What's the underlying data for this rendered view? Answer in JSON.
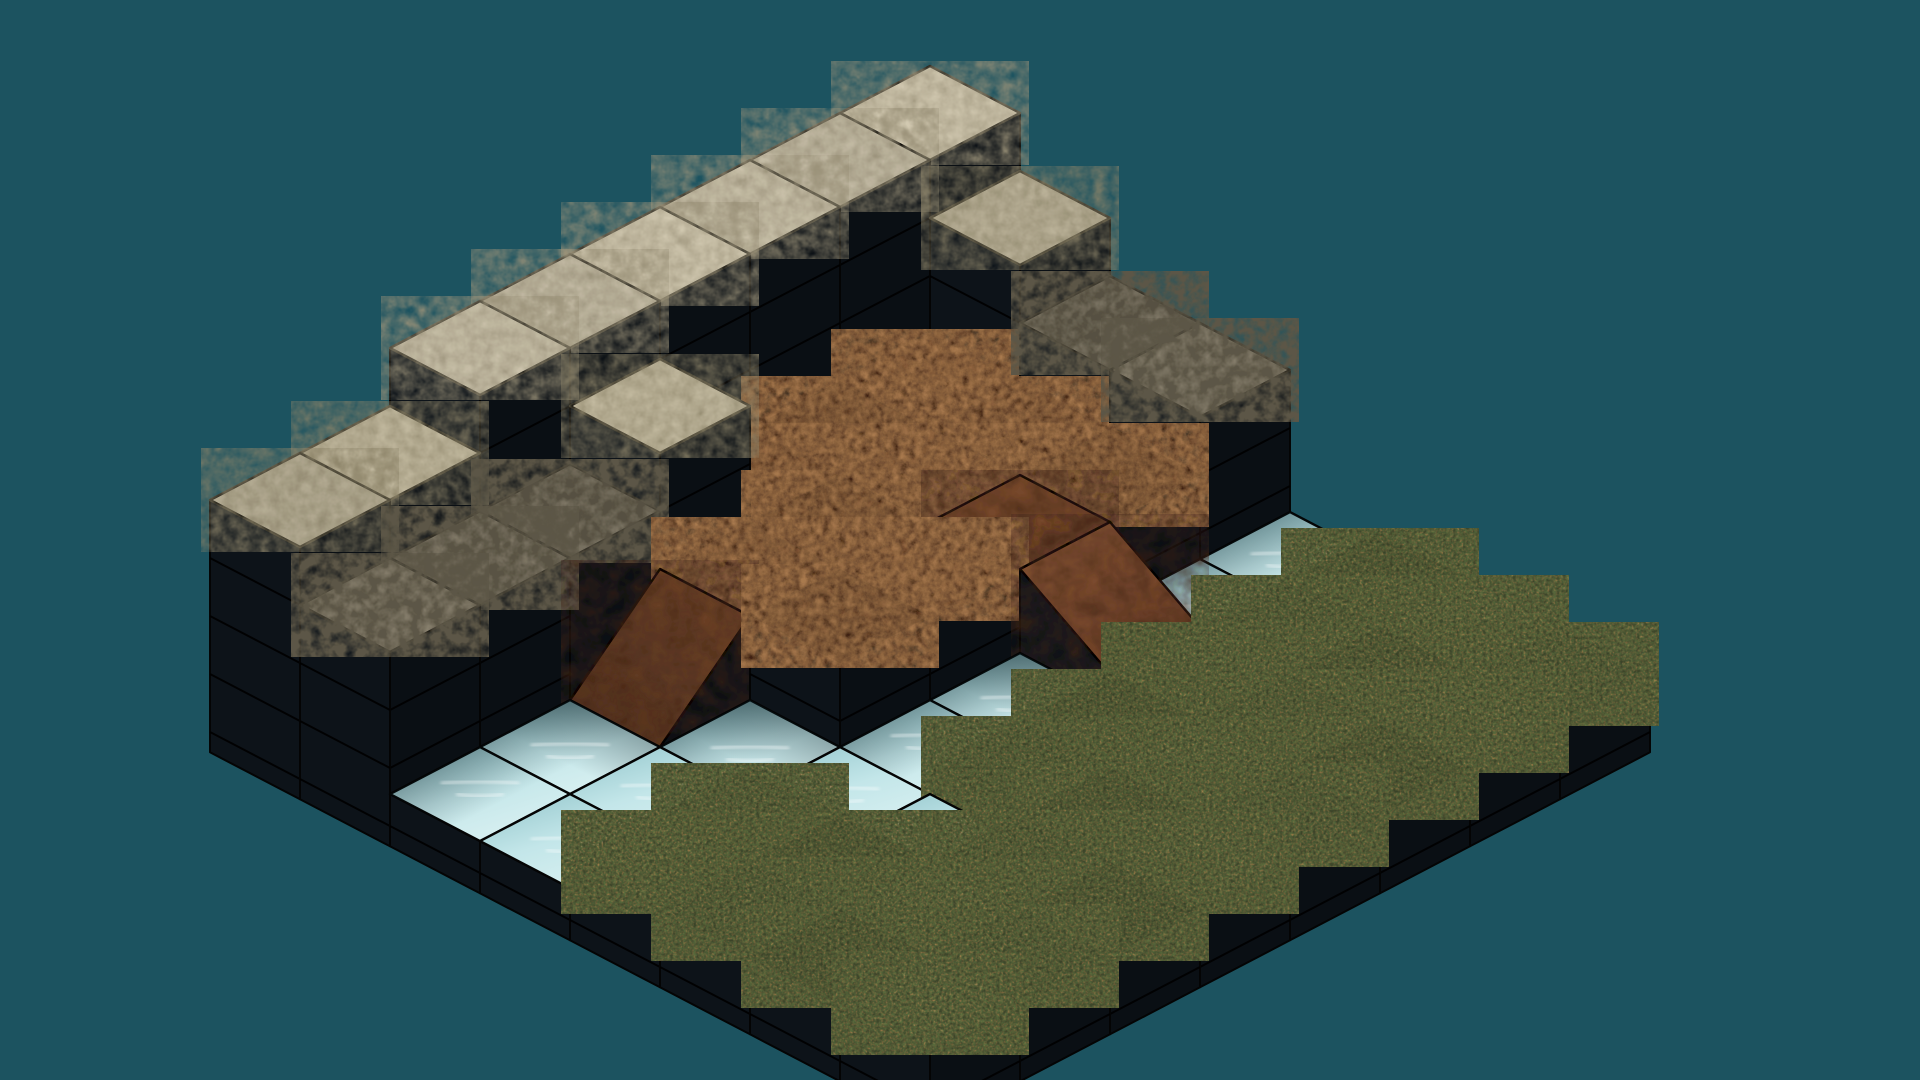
{
  "scene": {
    "name": "isometric-voxel-terrain-level",
    "description": "Isometric puzzle-game terrain of stacked blocks: sandstone wall, stone steps, dirt plateau, river with two dirt ramps, grass plain",
    "background": "#1c5360",
    "canvas": {
      "width": 1920,
      "height": 1080
    }
  },
  "projection": {
    "origin_x": 930,
    "origin_y_top": 66,
    "tile_half_width": 90,
    "tile_half_height": 47,
    "block_height": 58,
    "water_level": 0.55,
    "base_level": -0.35,
    "wall_top_level": 5
  },
  "materials": {
    "sand5": {
      "name": "sandstone-high",
      "fill": "#d2c9b1",
      "mottle": "#9b9279"
    },
    "sand4": {
      "name": "sandstone-low",
      "fill": "#c5bca2",
      "mottle": "#8d8469"
    },
    "stone": {
      "name": "grey-stone",
      "fill": "#8b8371",
      "mottle": "#5c5646"
    },
    "dirt": {
      "name": "dirt",
      "fill": "#7c4e30",
      "mottle": "#3f2315",
      "mottle2": "#a97a4e"
    },
    "rampflat": {
      "name": "dirt-ramp-landing",
      "fill": "#7a4c2e"
    },
    "rampI": {
      "name": "dirt-ramp-east",
      "hi": "#8f5a39",
      "lo": "#6f4128"
    },
    "rampJ": {
      "name": "dirt-ramp-south",
      "hi": "#72462a",
      "lo": "#543321"
    },
    "grass": {
      "name": "grass",
      "fill": "#a1a171",
      "mottle": "#c18d57",
      "mottle2": "#5d7040",
      "mottle3": "#3e462c"
    },
    "water": {
      "name": "water",
      "fill": "#c3e6e9",
      "deep": "#8fc3c9",
      "streak": "#ffffff"
    },
    "side_se": "#0a0f14",
    "side_sw": "#0d1319",
    "sliver": "#06090d",
    "outline": "#040404",
    "water_shadow": "rgba(6,25,30,0.55)"
  },
  "terrain": {
    "rows": 8,
    "cols": 8,
    "legend": {
      "B5": "sandstone block, top at level 5",
      "B4": "sandstone block, top at level 4",
      "G3": "grey stone block, top at level 3",
      "D2": "dirt block, top at level 2",
      "F2": "smooth dirt ramp landing at level 2",
      "I": "dirt ramp sloping down toward south-east, level 2 to 1",
      "J": "dirt ramp sloping down toward south-west, level 2 to water",
      "W": "water surface at level 0.55",
      "g1": "grass block, top at level 1"
    },
    "tiles": [
      [
        "B5",
        "B4",
        "G3",
        "G3",
        "W",
        "g1",
        "g1",
        "g1"
      ],
      [
        "B5",
        "D2",
        "D2",
        "D2",
        "W",
        "g1",
        "g1",
        "g1"
      ],
      [
        "B5",
        "D2",
        "D2",
        "F2",
        "I",
        "g1",
        "g1",
        "g1"
      ],
      [
        "B5",
        "D2",
        "D2",
        "D2",
        "W",
        "g1",
        "g1",
        "g1"
      ],
      [
        "B5",
        "B4",
        "D2",
        "D2",
        "W",
        "g1",
        "g1",
        "g1"
      ],
      [
        "B5",
        "G3",
        "J",
        "W",
        "W",
        "W",
        "g1",
        "g1"
      ],
      [
        "B4",
        "G3",
        "W",
        "W",
        "g1",
        "g1",
        "g1",
        "g1"
      ],
      [
        "B4",
        "G3",
        "W",
        "W",
        "g1",
        "g1",
        "g1",
        "g1"
      ]
    ]
  }
}
